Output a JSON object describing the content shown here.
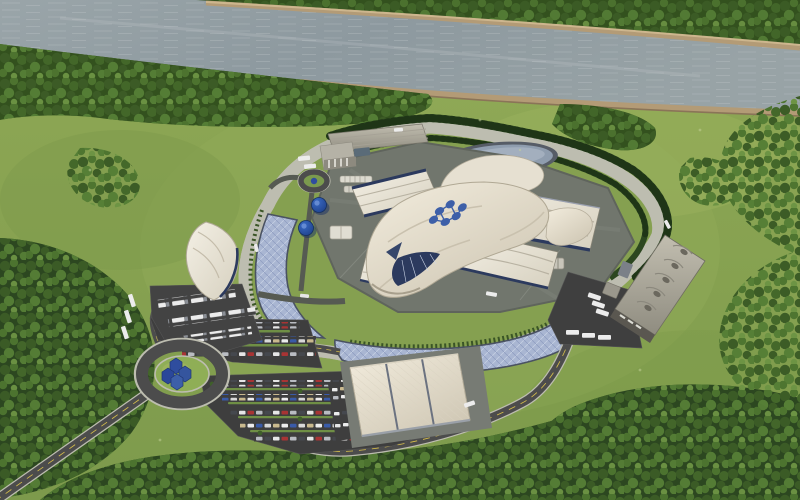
{
  "scene": {
    "type": "aerial-3d-rendering",
    "labels": {
      "river": "river",
      "far_bank": "far river bank with trees",
      "near_bank": "near river bank forest",
      "terrain": "grass terrain",
      "ring_road": "elliptical perimeter ring road",
      "campus_pad": "central plant concrete pad",
      "central_building": "iconic wavy-roof reactor building with logo",
      "roof_logo": "blue droplet-cluster logo on roof",
      "top_warehouse": "north warehouse building",
      "nw_building": "northwest barrel-roof building",
      "east_buildings": "east wavy-roof turbine buildings",
      "south_building": "south large white building",
      "west_gatehouse": "west tent-roof gatehouse building",
      "east_warehouse": "east barrel warehouse with truck apron",
      "top_pond": "oval retention pond",
      "left_pond": "west crescent retention pond",
      "bottom_pond": "south crescent retention pond",
      "main_roundabout": "southwest roundabout with logo sculpture",
      "small_roundabout": "campus mini roundabout",
      "east_roundabout": "east roundabout",
      "parking_main": "main visitor parking lot with cars",
      "parking_upper": "upper parking lot with cars",
      "truck_apron": "truck parking apron",
      "access_road": "southwest access road",
      "south_road": "south connector road",
      "blue_tanks": "blue storage tanks",
      "logo_sculpture": "blue logo sculpture",
      "hedges": "tree hedge rows along ring road",
      "forest": "forest tree clusters"
    }
  },
  "palette": {
    "grass": "#87a251",
    "grassLight": "#9db45e",
    "grassDark": "#74914a",
    "forest": "#3a5a24",
    "forestDark": "#2c4720",
    "water": "#96a1a6",
    "waterLight": "#b9c1c3",
    "sand": "#b39b76",
    "sandLight": "#cdb68e",
    "road": "#4c4c4c",
    "asphalt": "#3e3e3e",
    "curb": "#bdbdb0",
    "pad": "#71766d",
    "pond": "#a9b6d2",
    "pondRim": "#4a5262",
    "pondTop": "#8f9dae",
    "roofWhite": "#ece8dd",
    "roofShade": "#c9c2b2",
    "roofTan": "#b8b4a8",
    "cream": "#efe9da",
    "navy": "#2c3a5e",
    "blue": "#3d5fa8",
    "blueDark": "#1e3570",
    "hedge": "#2f4a24",
    "yellow": "#d9c04a",
    "white": "#ececec",
    "metal": "#8b8f96"
  }
}
